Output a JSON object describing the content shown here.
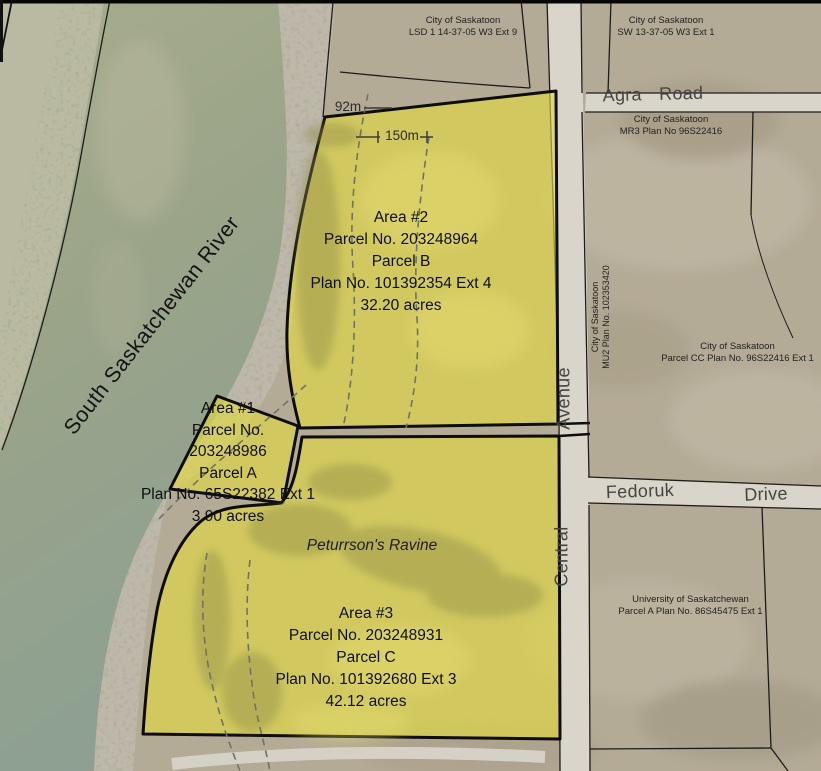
{
  "jurisdictions": {
    "lsd1": {
      "line1": "City of Saskatoon",
      "line2": "LSD 1 14-37-05 W3 Ext 9"
    },
    "sw13": {
      "line1": "City of Saskatoon",
      "line2": "SW 13-37-05 W3 Ext 1"
    },
    "mr3": {
      "line1": "City of Saskatoon",
      "line2": "MR3 Plan No 96S22416"
    },
    "mu2": {
      "line1": "City of Saskatoon",
      "line2": "MU2 Plan No. 102353420"
    },
    "parcel_cc": {
      "line1": "City of Saskatoon",
      "line2": "Parcel CC Plan No. 96S22416 Ext 1"
    },
    "university": {
      "line1": "University of Saskatchewan",
      "line2": "Parcel A Plan No. 86S45475 Ext 1"
    }
  },
  "roads": {
    "agra": "Agra Road",
    "central_word": "Central",
    "avenue_word": "Avenue",
    "fedoruk_word": "Fedoruk",
    "drive_word": "Drive"
  },
  "water": {
    "river_name": "South Saskatchewan River"
  },
  "features": {
    "ravine_name": "Peturrson's Ravine"
  },
  "measurements": {
    "d92": "92m",
    "d150": "150m"
  },
  "parcels": {
    "area1": {
      "title": "Area #1",
      "parcel_no_label": "Parcel No.",
      "parcel_no": "203248986",
      "parcel_letter": "Parcel A",
      "plan": "Plan No. 65S22382 Ext 1",
      "acres": "3.90 acres"
    },
    "area2": {
      "title": "Area #2",
      "parcel_no": "Parcel No. 203248964",
      "parcel_letter": "Parcel B",
      "plan": "Plan No. 101392354 Ext 4",
      "acres": "32.20 acres"
    },
    "area3": {
      "title": "Area #3",
      "parcel_no": "Parcel No. 203248931",
      "parcel_letter": "Parcel C",
      "plan": "Plan No. 101392680 Ext 3",
      "acres": "42.12 acres"
    }
  },
  "colors": {
    "parcel_highlight": "#d5cc5c",
    "river_water": "#9aa489",
    "sand_bank": "#bdb8a9",
    "land": "#b4ab97",
    "road": "#d9d5ca",
    "boundary": "#0d0d0d"
  }
}
